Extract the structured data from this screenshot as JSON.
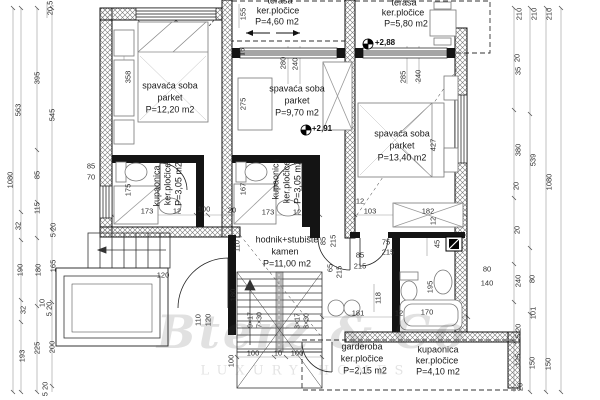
{
  "watermark": {
    "brand": "Bterz & Co",
    "tagline": "LUXURY HOMES"
  },
  "colors": {
    "wall": "#141414",
    "hatch": "#555555",
    "dimension": "#2e2e2e",
    "furniture": "#666666"
  },
  "plan": {
    "texts": [
      {
        "n": "room-name",
        "c": "room",
        "t": "spavaća soba",
        "x": 170,
        "y": 86
      },
      {
        "n": "room-finish",
        "c": "room",
        "t": "parket",
        "x": 170,
        "y": 98
      },
      {
        "n": "room-area",
        "c": "room",
        "t": "P=12,20 m2",
        "x": 170,
        "y": 110
      },
      {
        "n": "room-name",
        "c": "room",
        "t": "spavaća soba",
        "x": 297,
        "y": 89
      },
      {
        "n": "room-finish",
        "c": "room",
        "t": "parket",
        "x": 297,
        "y": 101
      },
      {
        "n": "room-area",
        "c": "room",
        "t": "P=9,70 m2",
        "x": 297,
        "y": 113
      },
      {
        "n": "room-name",
        "c": "room",
        "t": "spavaća soba",
        "x": 402,
        "y": 134
      },
      {
        "n": "room-finish",
        "c": "room",
        "t": "parket",
        "x": 402,
        "y": 146
      },
      {
        "n": "room-area",
        "c": "room",
        "t": "P=13,40 m2",
        "x": 402,
        "y": 158
      },
      {
        "n": "room-name",
        "c": "room",
        "t": "terasa",
        "x": 280,
        "y": 1
      },
      {
        "n": "room-finish",
        "c": "room",
        "t": "ker.pločice",
        "x": 278,
        "y": 11
      },
      {
        "n": "room-area",
        "c": "room",
        "t": "P=4,60 m2",
        "x": 277,
        "y": 22
      },
      {
        "n": "room-name",
        "c": "room",
        "t": "terasa",
        "x": 404,
        "y": 3
      },
      {
        "n": "room-finish",
        "c": "room",
        "t": "ker.pločice",
        "x": 403,
        "y": 13
      },
      {
        "n": "room-area",
        "c": "room",
        "t": "P=5,80 m2",
        "x": 406,
        "y": 24
      },
      {
        "n": "room-name",
        "c": "room",
        "t": "kupaonica",
        "x": 157,
        "y": 186,
        "r": -90
      },
      {
        "n": "room-finish",
        "c": "room",
        "t": "ker.pločice",
        "x": 168,
        "y": 184,
        "r": -90
      },
      {
        "n": "room-area",
        "c": "room",
        "t": "P=3,05 m2",
        "x": 179,
        "y": 184,
        "r": -90
      },
      {
        "n": "room-name",
        "c": "room",
        "t": "kupaonica",
        "x": 276,
        "y": 179,
        "r": -90
      },
      {
        "n": "room-finish",
        "c": "room",
        "t": "ker.pločice",
        "x": 287,
        "y": 182,
        "r": -90
      },
      {
        "n": "room-area",
        "c": "room",
        "t": "P=3,05 m2",
        "x": 298,
        "y": 182,
        "r": -90
      },
      {
        "n": "room-name",
        "c": "room",
        "t": "hodnik+stubište",
        "x": 287,
        "y": 240
      },
      {
        "n": "room-finish",
        "c": "room",
        "t": "kamen",
        "x": 285,
        "y": 252
      },
      {
        "n": "room-area",
        "c": "room",
        "t": "P=11,00 m2",
        "x": 287,
        "y": 264
      },
      {
        "n": "room-name",
        "c": "room",
        "t": "garderoba",
        "x": 362,
        "y": 347
      },
      {
        "n": "room-finish",
        "c": "room",
        "t": "ker.pločice",
        "x": 362,
        "y": 359
      },
      {
        "n": "room-area",
        "c": "room",
        "t": "P=2,15 m2",
        "x": 365,
        "y": 371
      },
      {
        "n": "room-name",
        "c": "room",
        "t": "kupaonica",
        "x": 438,
        "y": 350
      },
      {
        "n": "room-finish",
        "c": "room",
        "t": "ker.pločice",
        "x": 437,
        "y": 361
      },
      {
        "n": "room-area",
        "c": "room",
        "t": "P=4,10 m2",
        "x": 438,
        "y": 372
      },
      {
        "n": "level-marker",
        "c": "level",
        "t": "+2,88",
        "x": 385,
        "y": 43
      },
      {
        "n": "level-marker",
        "c": "level",
        "t": "+2,91",
        "x": 322,
        "y": 129
      },
      {
        "n": "dim",
        "c": "dim",
        "t": "20,5",
        "x": 50,
        "y": 8,
        "r": -90
      },
      {
        "n": "dim",
        "c": "dim",
        "t": "563",
        "x": 18,
        "y": 110,
        "r": -90
      },
      {
        "n": "dim",
        "c": "dim",
        "t": "395",
        "x": 37,
        "y": 78,
        "r": -90
      },
      {
        "n": "dim",
        "c": "dim",
        "t": "545",
        "x": 52,
        "y": 115,
        "r": -90
      },
      {
        "n": "dim",
        "c": "dim",
        "t": "1080",
        "x": 10,
        "y": 180,
        "r": -90
      },
      {
        "n": "dim",
        "c": "dim",
        "t": "85",
        "x": 37,
        "y": 175,
        "r": -90
      },
      {
        "n": "dim",
        "c": "dim",
        "t": "115",
        "x": 37,
        "y": 208,
        "r": -90
      },
      {
        "n": "dim",
        "c": "dim",
        "t": "32",
        "x": 18,
        "y": 226,
        "r": -90
      },
      {
        "n": "dim",
        "c": "dim",
        "t": "5 20",
        "x": 53,
        "y": 230,
        "r": -90
      },
      {
        "n": "dim",
        "c": "dim",
        "t": "190",
        "x": 20,
        "y": 270,
        "r": -90
      },
      {
        "n": "dim",
        "c": "dim",
        "t": "180",
        "x": 38,
        "y": 270,
        "r": -90
      },
      {
        "n": "dim",
        "c": "dim",
        "t": "165",
        "x": 53,
        "y": 266,
        "r": -90
      },
      {
        "n": "dim",
        "c": "dim",
        "t": "32",
        "x": 23,
        "y": 310,
        "r": -90
      },
      {
        "n": "dim",
        "c": "dim",
        "t": "10",
        "x": 42,
        "y": 303,
        "r": -90
      },
      {
        "n": "dim",
        "c": "dim",
        "t": "5 20",
        "x": 49,
        "y": 309,
        "r": -90
      },
      {
        "n": "dim",
        "c": "dim",
        "t": "193",
        "x": 22,
        "y": 356,
        "r": -90
      },
      {
        "n": "dim",
        "c": "dim",
        "t": "225",
        "x": 37,
        "y": 348,
        "r": -90
      },
      {
        "n": "dim",
        "c": "dim",
        "t": "200",
        "x": 52,
        "y": 347,
        "r": -90
      },
      {
        "n": "dim",
        "c": "dim",
        "t": "5 20",
        "x": 45,
        "y": 389,
        "r": -90
      },
      {
        "n": "dim",
        "c": "dim",
        "t": "210",
        "x": 519,
        "y": 14,
        "r": -90
      },
      {
        "n": "dim",
        "c": "dim",
        "t": "210",
        "x": 534,
        "y": 14,
        "r": -90
      },
      {
        "n": "dim",
        "c": "dim",
        "t": "210",
        "x": 549,
        "y": 14,
        "r": -90
      },
      {
        "n": "dim",
        "c": "dim",
        "t": "20",
        "x": 517,
        "y": 58,
        "r": -90
      },
      {
        "n": "dim",
        "c": "dim",
        "t": "35",
        "x": 518,
        "y": 71,
        "r": -90
      },
      {
        "n": "dim",
        "c": "dim",
        "t": "380",
        "x": 518,
        "y": 150,
        "r": -90
      },
      {
        "n": "dim",
        "c": "dim",
        "t": "539",
        "x": 533,
        "y": 160,
        "r": -90
      },
      {
        "n": "dim",
        "c": "dim",
        "t": "20",
        "x": 516,
        "y": 186,
        "r": -90
      },
      {
        "n": "dim",
        "c": "dim",
        "t": "1080",
        "x": 549,
        "y": 182,
        "r": -90
      },
      {
        "n": "dim",
        "c": "dim",
        "t": "20",
        "x": 517,
        "y": 230,
        "r": -90
      },
      {
        "n": "dim",
        "c": "dim",
        "t": "240",
        "x": 518,
        "y": 281,
        "r": -90
      },
      {
        "n": "dim",
        "c": "dim",
        "t": "80",
        "x": 532,
        "y": 279,
        "r": -90
      },
      {
        "n": "dim",
        "c": "dim",
        "t": "101",
        "x": 533,
        "y": 313,
        "r": -90
      },
      {
        "n": "dim",
        "c": "dim",
        "t": "5 20",
        "x": 518,
        "y": 331,
        "r": -90
      },
      {
        "n": "dim",
        "c": "dim",
        "t": "125",
        "x": 518,
        "y": 360,
        "r": -90
      },
      {
        "n": "dim",
        "c": "dim",
        "t": "150",
        "x": 532,
        "y": 363,
        "r": -90
      },
      {
        "n": "dim",
        "c": "dim",
        "t": "150",
        "x": 548,
        "y": 364,
        "r": -90
      },
      {
        "n": "dim",
        "c": "dim",
        "t": "20",
        "x": 520,
        "y": 387,
        "r": -90
      },
      {
        "n": "dim",
        "c": "dim",
        "t": "358",
        "x": 128,
        "y": 77,
        "r": -90
      },
      {
        "n": "dim",
        "c": "dim",
        "t": "155",
        "x": 243,
        "y": 14,
        "r": -90
      },
      {
        "n": "dim",
        "c": "dim",
        "t": "16",
        "x": 242,
        "y": 52,
        "r": -90
      },
      {
        "n": "dim",
        "c": "dim",
        "t": "280",
        "x": 283,
        "y": 63,
        "r": -90
      },
      {
        "n": "dim",
        "c": "dim",
        "t": "240",
        "x": 295,
        "y": 64,
        "r": -90
      },
      {
        "n": "dim",
        "c": "dim",
        "t": "275",
        "x": 243,
        "y": 104,
        "r": -90
      },
      {
        "n": "dim",
        "c": "dim",
        "t": "285",
        "x": 403,
        "y": 77,
        "r": -90
      },
      {
        "n": "dim",
        "c": "dim",
        "t": "240",
        "x": 418,
        "y": 76,
        "r": -90
      },
      {
        "n": "dim",
        "c": "dim",
        "t": "427",
        "x": 433,
        "y": 145,
        "r": -90
      },
      {
        "n": "dim",
        "c": "dim",
        "t": "85",
        "x": 91,
        "y": 166
      },
      {
        "n": "dim",
        "c": "dim",
        "t": "70",
        "x": 91,
        "y": 177
      },
      {
        "n": "dim",
        "c": "dim",
        "t": "175",
        "x": 128,
        "y": 190,
        "r": -90
      },
      {
        "n": "dim",
        "c": "dim",
        "t": "173",
        "x": 147,
        "y": 211
      },
      {
        "n": "dim",
        "c": "dim",
        "t": "12",
        "x": 177,
        "y": 211
      },
      {
        "n": "dim",
        "c": "dim",
        "t": "100",
        "x": 204,
        "y": 209
      },
      {
        "n": "dim",
        "c": "dim",
        "t": "20",
        "x": 232,
        "y": 210
      },
      {
        "n": "dim",
        "c": "dim",
        "t": "167",
        "x": 243,
        "y": 189,
        "r": -90
      },
      {
        "n": "dim",
        "c": "dim",
        "t": "173",
        "x": 268,
        "y": 212
      },
      {
        "n": "dim",
        "c": "dim",
        "t": "12",
        "x": 297,
        "y": 212
      },
      {
        "n": "dim",
        "c": "dim",
        "t": "110",
        "x": 237,
        "y": 246,
        "r": -90
      },
      {
        "n": "dim",
        "c": "dim",
        "t": "12",
        "x": 360,
        "y": 201
      },
      {
        "n": "dim",
        "c": "dim",
        "t": "103",
        "x": 370,
        "y": 211
      },
      {
        "n": "dim",
        "c": "dim",
        "t": "182",
        "x": 428,
        "y": 211
      },
      {
        "n": "dim",
        "c": "dim",
        "t": "12",
        "x": 433,
        "y": 221,
        "r": -90
      },
      {
        "n": "dim",
        "c": "dim",
        "t": "45",
        "x": 437,
        "y": 244,
        "r": -90
      },
      {
        "n": "dim",
        "c": "dim",
        "t": "80",
        "x": 487,
        "y": 269
      },
      {
        "n": "dim",
        "c": "dim",
        "t": "140",
        "x": 487,
        "y": 283
      },
      {
        "n": "dim",
        "c": "dim",
        "t": "195",
        "x": 430,
        "y": 287,
        "r": -90
      },
      {
        "n": "dim",
        "c": "dim",
        "t": "85",
        "x": 323,
        "y": 241,
        "r": -90
      },
      {
        "n": "dim",
        "c": "dim",
        "t": "215",
        "x": 333,
        "y": 241,
        "r": -90
      },
      {
        "n": "dim",
        "c": "dim",
        "t": "75",
        "x": 386,
        "y": 242
      },
      {
        "n": "dim",
        "c": "dim",
        "t": "215",
        "x": 388,
        "y": 252
      },
      {
        "n": "dim",
        "c": "dim",
        "t": "85",
        "x": 360,
        "y": 255
      },
      {
        "n": "dim",
        "c": "dim",
        "t": "215",
        "x": 360,
        "y": 266
      },
      {
        "n": "dim",
        "c": "dim",
        "t": "65",
        "x": 330,
        "y": 268,
        "r": -90
      },
      {
        "n": "dim",
        "c": "dim",
        "t": "215",
        "x": 339,
        "y": 272,
        "r": -90
      },
      {
        "n": "dim",
        "c": "dim",
        "t": "118",
        "x": 378,
        "y": 298,
        "r": -90
      },
      {
        "n": "dim",
        "c": "dim",
        "t": "181",
        "x": 358,
        "y": 313
      },
      {
        "n": "dim",
        "c": "dim",
        "t": "12",
        "x": 399,
        "y": 313
      },
      {
        "n": "dim",
        "c": "dim",
        "t": "170",
        "x": 427,
        "y": 312
      },
      {
        "n": "stair-spec",
        "c": "stair",
        "t": "9×17",
        "x": 251,
        "y": 320,
        "r": -90
      },
      {
        "n": "stair-spec",
        "c": "stair",
        "t": "7×30",
        "x": 260,
        "y": 320,
        "r": -90
      },
      {
        "n": "stair-spec",
        "c": "stair",
        "t": "3×17",
        "x": 298,
        "y": 321,
        "r": -90
      },
      {
        "n": "stair-spec",
        "c": "stair",
        "t": "8×30",
        "x": 307,
        "y": 321,
        "r": -90
      },
      {
        "n": "dim",
        "c": "dim",
        "t": "100",
        "x": 253,
        "y": 353
      },
      {
        "n": "dim",
        "c": "dim",
        "t": "10",
        "x": 278,
        "y": 353
      },
      {
        "n": "dim",
        "c": "dim",
        "t": "100",
        "x": 297,
        "y": 353
      },
      {
        "n": "dim",
        "c": "dim",
        "t": "180",
        "x": 233,
        "y": 295,
        "r": -90
      },
      {
        "n": "dim",
        "c": "dim",
        "t": "100",
        "x": 231,
        "y": 361,
        "r": -90
      },
      {
        "n": "dim",
        "c": "dim",
        "t": "120",
        "x": 163,
        "y": 275
      },
      {
        "n": "dim",
        "c": "dim",
        "t": "110",
        "x": 198,
        "y": 320,
        "r": -90
      },
      {
        "n": "dim",
        "c": "dim",
        "t": "120",
        "x": 208,
        "y": 320,
        "r": -90
      }
    ]
  }
}
